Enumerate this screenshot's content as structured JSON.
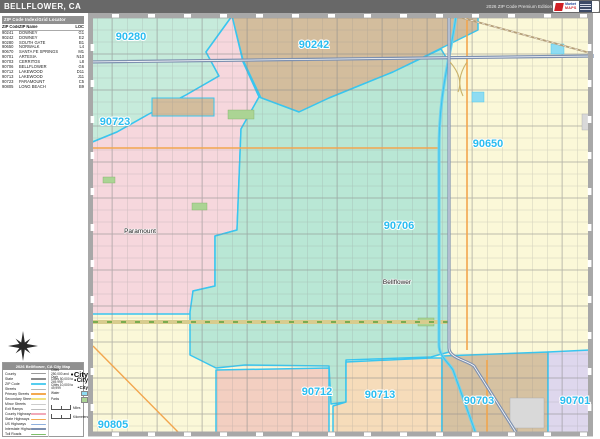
{
  "title_bar": {
    "title": "BELLFLOWER, CA",
    "edition": "2026 ZIP Code Premium Edition",
    "logo_line1": "Market",
    "logo_line2": "MAPS"
  },
  "index_panel": {
    "header": "ZIP Code Index/Grid Locator",
    "columns": {
      "zip": "ZIP Code",
      "name": "ZIP Name",
      "loc": "LOC"
    },
    "rows": [
      {
        "zip": "90241",
        "name": "DOWNEY",
        "loc": "G1"
      },
      {
        "zip": "90242",
        "name": "DOWNEY",
        "loc": "E2"
      },
      {
        "zip": "90280",
        "name": "SOUTH GATE",
        "loc": "B1"
      },
      {
        "zip": "90650",
        "name": "NORWALK",
        "loc": "L4"
      },
      {
        "zip": "90670",
        "name": "SANTA FE SPRINGS",
        "loc": "M1"
      },
      {
        "zip": "90701",
        "name": "ARTESIA",
        "loc": "N10"
      },
      {
        "zip": "90703",
        "name": "CERRITOS",
        "loc": "L8"
      },
      {
        "zip": "90706",
        "name": "BELLFLOWER",
        "loc": "G6"
      },
      {
        "zip": "90712",
        "name": "LAKEWOOD",
        "loc": "D11"
      },
      {
        "zip": "90713",
        "name": "LAKEWOOD",
        "loc": "J11"
      },
      {
        "zip": "90723",
        "name": "PARAMOUNT",
        "loc": "C5"
      },
      {
        "zip": "90805",
        "name": "LONG BEACH",
        "loc": "B9"
      }
    ]
  },
  "legend": {
    "header": "2026 Bellflower, CA City Map",
    "line_items": [
      {
        "label": "County",
        "color": "#9a9a9a",
        "h": 1.2
      },
      {
        "label": "State",
        "color": "#8a8a8a",
        "h": 2
      },
      {
        "label": "ZIP Code",
        "color": "#55cdef",
        "h": 2.4
      },
      {
        "label": "Streets",
        "color": "#b5b5b5",
        "h": 0.8
      },
      {
        "label": "Primary Streets",
        "color": "#f4a94f",
        "h": 1.6
      },
      {
        "label": "Secondary Streets",
        "color": "#f0e080",
        "h": 1.6
      },
      {
        "label": "Minor Streets",
        "color": "#cccccc",
        "h": 0.8
      },
      {
        "label": "Exit Ramps",
        "color": "#bdbdbd",
        "h": 0.8
      },
      {
        "label": "County Highways",
        "color": "#f2a9b8",
        "h": 1.6
      },
      {
        "label": "State Highways",
        "color": "#f4a94f",
        "h": 1.6
      },
      {
        "label": "US Highways",
        "color": "#8fb0dd",
        "h": 1.6
      },
      {
        "label": "Interstate Highways",
        "color": "#7d8fae",
        "h": 2
      },
      {
        "label": "Toll Roads",
        "color": "#7fbf6a",
        "h": 1.6
      }
    ],
    "point_items": [
      {
        "label": "Cities 250,000 and Over",
        "sample": "City",
        "size": 7.5
      },
      {
        "label": "Cities 50,000 to 249,999",
        "sample": "City",
        "size": 6
      },
      {
        "label": "Cities 10,000 to 49,999",
        "sample": "City",
        "size": 4.5
      },
      {
        "label": "Water",
        "swatch": "#8edcf2"
      },
      {
        "label": "Parks",
        "swatch": "#abd494"
      }
    ],
    "scales": [
      {
        "label": "Miles"
      },
      {
        "label": "Kilometers"
      }
    ]
  },
  "map": {
    "zip_labels": [
      {
        "text": "90280",
        "x": 131,
        "y": 40
      },
      {
        "text": "90242",
        "x": 314,
        "y": 48
      },
      {
        "text": "90723",
        "x": 115,
        "y": 125
      },
      {
        "text": "90650",
        "x": 488,
        "y": 147
      },
      {
        "text": "90706",
        "x": 399,
        "y": 229
      },
      {
        "text": "90805",
        "x": 113,
        "y": 428
      },
      {
        "text": "90712",
        "x": 317,
        "y": 395
      },
      {
        "text": "90713",
        "x": 380,
        "y": 398
      },
      {
        "text": "90703",
        "x": 479,
        "y": 404
      },
      {
        "text": "90701",
        "x": 575,
        "y": 404
      }
    ],
    "city_labels": [
      {
        "text": "Paramount",
        "x": 140,
        "y": 233
      },
      {
        "text": "Bellflower",
        "x": 397,
        "y": 284
      }
    ],
    "colors": {
      "base": "#fbf8d8",
      "mint": "#c6ebdb",
      "teal": "#b9e7d5",
      "pink": "#f6d7dd",
      "tan": "#d3bd9d",
      "salmon": "#f3cfc1",
      "peach": "#f6dcba",
      "tan2": "#d6c2a2",
      "lavender": "#ded7ed",
      "zip_label_accent": "#2bbdf0",
      "boundary_accent": "#38c6f0",
      "frame_gray": "#a8a8a8"
    }
  }
}
